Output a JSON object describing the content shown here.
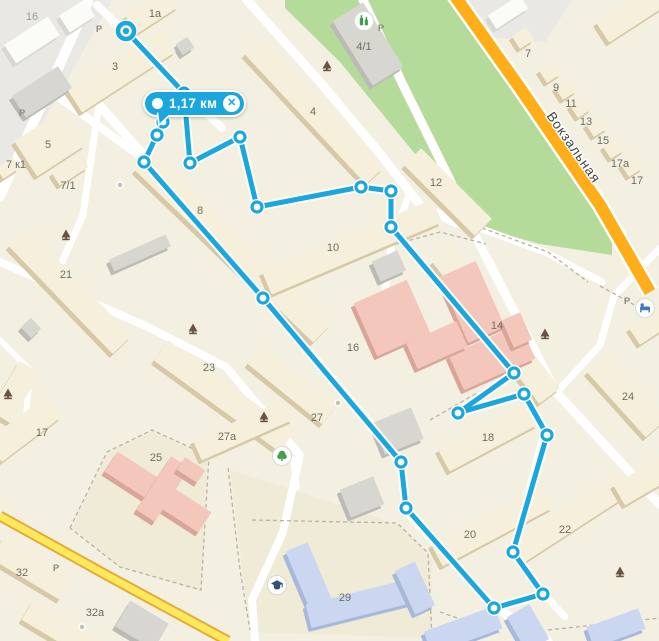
{
  "measurement": {
    "distance_label": "1,17 км",
    "close_glyph": "✕"
  },
  "street_label": {
    "text": "Вокзальная",
    "x": 570,
    "y": 150,
    "rot": 55
  },
  "colors": {
    "bg": "#F3EFE1",
    "park": "#B5DB9B",
    "industrial": "#E9E8E4",
    "yard": "#EFEBD7",
    "road": "#FFFFFF",
    "yellow": "#FFE95A",
    "yellowCase": "#E2AC3B",
    "orange": "#FFAD19",
    "orangeCase": "#FFFFFF",
    "dashed": "#B9B2A0",
    "route": "#1BA7DE",
    "routeHalo": "#FFFFFF",
    "label_num": "#6E6E62",
    "label_p": "#8C8C80",
    "label_grey": "#9C9C98",
    "street_text": "#45453F",
    "bldg": {
      "b": [
        "#F5EFDB",
        "#D7C9A6"
      ],
      "w": [
        "#FBFBF8",
        "#D8D7D2"
      ],
      "g": [
        "#D7D6D1",
        "#BBBAB5"
      ],
      "p": [
        "#F3C7BC",
        "#D8A598"
      ],
      "l": [
        "#CBD7F0",
        "#A8B8DB"
      ]
    },
    "poi_shop": "#3E9B4F",
    "poi_hotel": "#3D7ABF",
    "poi_park": "#44A04C",
    "poi_school": "#30517A",
    "monument": "#6B5342",
    "poi_dot": "#C4C0B4"
  },
  "areas": {
    "industrial": [
      [
        [
          0,
          0
        ],
        [
          112,
          0
        ],
        [
          0,
          198
        ]
      ],
      [
        [
          462,
          0
        ],
        [
          572,
          0
        ],
        [
          545,
          42
        ],
        [
          478,
          36
        ]
      ]
    ],
    "park": [
      [
        285,
        0
      ],
      [
        455,
        0
      ],
      [
        470,
        12
      ],
      [
        560,
        150
      ],
      [
        612,
        243
      ],
      [
        612,
        255
      ],
      [
        540,
        244
      ],
      [
        468,
        224
      ],
      [
        420,
        160
      ],
      [
        340,
        62
      ],
      [
        285,
        8
      ]
    ],
    "yards": [
      [
        [
          230,
          470
        ],
        [
          400,
          525
        ],
        [
          432,
          560
        ],
        [
          430,
          638
        ],
        [
          250,
          632
        ]
      ],
      [
        [
          72,
          528
        ],
        [
          108,
          453
        ],
        [
          152,
          431
        ],
        [
          208,
          457
        ],
        [
          201,
          590
        ],
        [
          120,
          567
        ]
      ]
    ],
    "dashed": [
      [
        [
          342,
          259
        ],
        [
          440,
          232
        ],
        [
          486,
          244
        ]
      ],
      [
        [
          70,
          528
        ],
        [
          107,
          452
        ],
        [
          152,
          430
        ],
        [
          209,
          456
        ],
        [
          201,
          590
        ],
        [
          120,
          567
        ],
        [
          70,
          528
        ]
      ],
      [
        [
          228,
          468
        ],
        [
          240,
          570
        ],
        [
          250,
          630
        ]
      ],
      [
        [
          252,
          520
        ],
        [
          397,
          523
        ],
        [
          428,
          553
        ],
        [
          432,
          638
        ]
      ],
      [
        [
          482,
          228
        ],
        [
          548,
          252
        ],
        [
          588,
          282
        ]
      ],
      [
        [
          430,
          420
        ],
        [
          477,
          393
        ]
      ],
      [
        [
          440,
          612
        ],
        [
          500,
          633
        ]
      ],
      [
        [
          548,
          630
        ],
        [
          660,
          618
        ]
      ],
      [
        [
          600,
          286
        ],
        [
          658,
          318
        ]
      ]
    ]
  },
  "roads": {
    "white": [
      {
        "w": 10,
        "pts": [
          [
            0,
            196
          ],
          [
            88,
            2
          ]
        ]
      },
      {
        "w": 8,
        "pts": [
          [
            60,
            98
          ],
          [
            148,
            162
          ]
        ]
      },
      {
        "w": 9,
        "pts": [
          [
            100,
            106
          ],
          [
            148,
            160
          ],
          [
            263,
            298
          ],
          [
            401,
            460
          ],
          [
            406,
            510
          ],
          [
            493,
            606
          ],
          [
            548,
            641
          ]
        ]
      },
      {
        "w": 7,
        "pts": [
          [
            98,
            110
          ],
          [
            83,
            215
          ],
          [
            62,
            262
          ]
        ]
      },
      {
        "w": 8,
        "pts": [
          [
            0,
            262
          ],
          [
            148,
            327
          ],
          [
            226,
            367
          ],
          [
            300,
            455
          ],
          [
            283,
            532
          ],
          [
            252,
            600
          ],
          [
            255,
            641
          ]
        ]
      },
      {
        "w": 8,
        "pts": [
          [
            97,
            5
          ],
          [
            170,
            78
          ],
          [
            222,
            128
          ]
        ]
      },
      {
        "w": 9,
        "pts": [
          [
            247,
            0
          ],
          [
            320,
            82
          ],
          [
            377,
            150
          ],
          [
            420,
            205
          ],
          [
            456,
            223
          ]
        ]
      },
      {
        "w": 9,
        "pts": [
          [
            363,
            0
          ],
          [
            403,
            85
          ],
          [
            450,
            180
          ],
          [
            468,
            222
          ],
          [
            556,
            392
          ],
          [
            660,
            505
          ]
        ]
      },
      {
        "w": 7,
        "pts": [
          [
            468,
            224
          ],
          [
            545,
            252
          ],
          [
            602,
            282
          ]
        ]
      },
      {
        "w": 7,
        "pts": [
          [
            660,
            248
          ],
          [
            614,
            296
          ],
          [
            600,
            345
          ],
          [
            558,
            391
          ]
        ]
      },
      {
        "w": 7,
        "pts": [
          [
            545,
            428
          ],
          [
            513,
            552
          ],
          [
            543,
            593
          ],
          [
            565,
            617
          ]
        ]
      },
      {
        "w": 6,
        "pts": [
          [
            263,
            438
          ],
          [
            293,
            460
          ],
          [
            297,
            487
          ]
        ]
      },
      {
        "w": 6,
        "pts": [
          [
            0,
            340
          ],
          [
            30,
            370
          ],
          [
            25,
            428
          ]
        ]
      },
      {
        "w": 7,
        "pts": [
          [
            410,
            192
          ],
          [
            392,
            240
          ],
          [
            384,
            300
          ]
        ]
      }
    ],
    "yellow": {
      "pts": [
        [
          0,
          516
        ],
        [
          110,
          577
        ],
        [
          228,
          641
        ]
      ],
      "w_case": 11,
      "w_core": 7
    },
    "orange": {
      "pts": [
        [
          452,
          -8
        ],
        [
          520,
          88
        ],
        [
          600,
          205
        ],
        [
          650,
          292
        ]
      ],
      "w_case": 17,
      "w_core": 12
    }
  },
  "buildings": [
    [
      152,
      11,
      50,
      22,
      -33,
      "b"
    ],
    [
      185,
      46,
      14,
      13,
      -33,
      "g"
    ],
    [
      122,
      71,
      112,
      26,
      -33,
      "b"
    ],
    [
      50,
      143,
      58,
      42,
      -33,
      "b"
    ],
    [
      70,
      170,
      34,
      15,
      -33,
      "b"
    ],
    [
      8,
      168,
      20,
      13,
      -33,
      "b"
    ],
    [
      233,
      247,
      248,
      26,
      44,
      "b"
    ],
    [
      352,
      247,
      185,
      25,
      -23,
      "b"
    ],
    [
      314,
      111,
      178,
      24,
      47,
      "b"
    ],
    [
      368,
      44,
      76,
      36,
      58,
      "g"
    ],
    [
      448,
      192,
      100,
      24,
      45,
      "b"
    ],
    [
      496,
      325,
      178,
      26,
      53,
      "b"
    ],
    [
      70,
      291,
      150,
      26,
      46,
      "b"
    ],
    [
      140,
      253,
      62,
      13,
      -24,
      "g"
    ],
    [
      31,
      328,
      15,
      14,
      46,
      "g"
    ],
    [
      224,
      396,
      155,
      25,
      36,
      "b"
    ],
    [
      292,
      385,
      96,
      23,
      39,
      "b"
    ],
    [
      243,
      430,
      100,
      22,
      -24,
      "b"
    ],
    [
      15,
      392,
      58,
      24,
      -59,
      "b"
    ],
    [
      24,
      429,
      75,
      26,
      -37,
      "b"
    ],
    [
      488,
      437,
      100,
      25,
      -28,
      "b"
    ],
    [
      492,
      526,
      125,
      25,
      -28,
      "b"
    ],
    [
      573,
      516,
      132,
      25,
      -33,
      "b"
    ],
    [
      626,
      396,
      88,
      26,
      48,
      "b"
    ],
    [
      652,
      325,
      42,
      20,
      -33,
      "b"
    ],
    [
      634,
      12,
      75,
      24,
      -33,
      "b"
    ],
    [
      523,
      38,
      17,
      15,
      -33,
      "b"
    ],
    [
      550,
      72,
      17,
      15,
      -33,
      "b"
    ],
    [
      566,
      89,
      17,
      15,
      -33,
      "b"
    ],
    [
      581,
      107,
      17,
      15,
      -33,
      "b"
    ],
    [
      597,
      126,
      17,
      15,
      -33,
      "b"
    ],
    [
      614,
      148,
      17,
      15,
      -33,
      "b"
    ],
    [
      632,
      166,
      17,
      15,
      -33,
      "b"
    ],
    [
      645,
      480,
      60,
      24,
      -30,
      "b"
    ],
    [
      32,
      568,
      80,
      26,
      31,
      "b"
    ],
    [
      62,
      630,
      80,
      24,
      31,
      "b"
    ],
    [
      142,
      625,
      45,
      30,
      31,
      "g"
    ],
    [
      32,
      40,
      52,
      22,
      -33,
      "w"
    ],
    [
      77,
      16,
      30,
      20,
      -33,
      "w"
    ],
    [
      42,
      92,
      55,
      26,
      -33,
      "g"
    ],
    [
      508,
      12,
      38,
      16,
      -33,
      "w"
    ],
    [
      389,
      266,
      28,
      22,
      -24,
      "g"
    ],
    [
      398,
      431,
      42,
      34,
      -22,
      "g"
    ],
    [
      362,
      497,
      36,
      30,
      -22,
      "g"
    ],
    [
      392,
      318,
      58,
      58,
      -24,
      "p"
    ],
    [
      472,
      302,
      40,
      72,
      -24,
      "p"
    ],
    [
      492,
      357,
      78,
      38,
      -24,
      "p"
    ],
    [
      437,
      345,
      55,
      28,
      -24,
      "p"
    ],
    [
      517,
      330,
      30,
      20,
      66,
      "p"
    ],
    [
      158,
      492,
      112,
      24,
      33,
      "p"
    ],
    [
      163,
      489,
      64,
      22,
      -57,
      "p"
    ],
    [
      191,
      470,
      24,
      15,
      33,
      "p"
    ],
    [
      311,
      581,
      74,
      24,
      67,
      "l"
    ],
    [
      362,
      603,
      110,
      24,
      -14,
      "l"
    ],
    [
      415,
      588,
      48,
      22,
      65,
      "l"
    ],
    [
      463,
      630,
      75,
      24,
      -20,
      "l"
    ],
    [
      528,
      628,
      40,
      26,
      60,
      "l"
    ],
    [
      616,
      628,
      55,
      22,
      -20,
      "l"
    ]
  ],
  "labels": [
    {
      "t": "16",
      "x": 32,
      "y": 16,
      "c": "grey"
    },
    {
      "t": "1a",
      "x": 155,
      "y": 13,
      "c": "num"
    },
    {
      "t": "P",
      "x": 99,
      "y": 28,
      "c": "p"
    },
    {
      "t": "3",
      "x": 115,
      "y": 66,
      "c": "num"
    },
    {
      "t": "P",
      "x": 22,
      "y": 112,
      "c": "p"
    },
    {
      "t": "5",
      "x": 48,
      "y": 144,
      "c": "num"
    },
    {
      "t": "7 к1",
      "x": 16,
      "y": 164,
      "c": "num"
    },
    {
      "t": "7/1",
      "x": 68,
      "y": 185,
      "c": "num"
    },
    {
      "t": "8",
      "x": 200,
      "y": 210,
      "c": "num"
    },
    {
      "t": "4/1",
      "x": 364,
      "y": 46,
      "c": "num"
    },
    {
      "t": "P",
      "x": 381,
      "y": 27,
      "c": "p"
    },
    {
      "t": "4",
      "x": 313,
      "y": 111,
      "c": "num"
    },
    {
      "t": "12",
      "x": 436,
      "y": 182,
      "c": "num"
    },
    {
      "t": "7",
      "x": 528,
      "y": 53,
      "c": "num"
    },
    {
      "t": "9",
      "x": 556,
      "y": 87,
      "c": "num"
    },
    {
      "t": "11",
      "x": 571,
      "y": 103,
      "c": "num"
    },
    {
      "t": "13",
      "x": 586,
      "y": 121,
      "c": "num"
    },
    {
      "t": "15",
      "x": 603,
      "y": 140,
      "c": "num"
    },
    {
      "t": "17a",
      "x": 620,
      "y": 163,
      "c": "num"
    },
    {
      "t": "17",
      "x": 637,
      "y": 180,
      "c": "num"
    },
    {
      "t": "21",
      "x": 66,
      "y": 274,
      "c": "num"
    },
    {
      "t": "10",
      "x": 333,
      "y": 247,
      "c": "num"
    },
    {
      "t": "16",
      "x": 353,
      "y": 347,
      "c": "num"
    },
    {
      "t": "14",
      "x": 497,
      "y": 325,
      "c": "num"
    },
    {
      "t": "23",
      "x": 209,
      "y": 367,
      "c": "num"
    },
    {
      "t": "24",
      "x": 628,
      "y": 396,
      "c": "num"
    },
    {
      "t": "27",
      "x": 317,
      "y": 417,
      "c": "num"
    },
    {
      "t": "27a",
      "x": 227,
      "y": 436,
      "c": "num"
    },
    {
      "t": "17",
      "x": 42,
      "y": 432,
      "c": "num"
    },
    {
      "t": "18",
      "x": 488,
      "y": 437,
      "c": "num"
    },
    {
      "t": "P",
      "x": 627,
      "y": 300,
      "c": "p"
    },
    {
      "t": "25",
      "x": 156,
      "y": 457,
      "c": "num"
    },
    {
      "t": "20",
      "x": 470,
      "y": 534,
      "c": "num"
    },
    {
      "t": "22",
      "x": 565,
      "y": 529,
      "c": "num"
    },
    {
      "t": "29",
      "x": 345,
      "y": 597,
      "c": "num"
    },
    {
      "t": "32",
      "x": 22,
      "y": 572,
      "c": "num"
    },
    {
      "t": "P",
      "x": 56,
      "y": 567,
      "c": "p"
    },
    {
      "t": "32a",
      "x": 95,
      "y": 612,
      "c": "num"
    }
  ],
  "pois": {
    "monuments": [
      [
        327,
        65
      ],
      [
        66,
        234
      ],
      [
        193,
        328
      ],
      [
        8,
        393
      ],
      [
        545,
        333
      ],
      [
        264,
        416
      ],
      [
        620,
        571
      ]
    ],
    "circles": [
      {
        "x": 364,
        "y": 21,
        "kind": "shop"
      },
      {
        "x": 645,
        "y": 308,
        "kind": "hotel"
      },
      {
        "x": 282,
        "y": 456,
        "kind": "park"
      },
      {
        "x": 277,
        "y": 585,
        "kind": "school"
      }
    ],
    "dots": [
      [
        120,
        185
      ],
      [
        82,
        627
      ],
      [
        338,
        403
      ]
    ]
  },
  "route": {
    "points": [
      [
        126,
        31
      ],
      [
        184,
        93
      ],
      [
        190,
        163
      ],
      [
        240,
        137
      ],
      [
        257,
        207
      ],
      [
        361,
        187
      ],
      [
        391,
        191
      ],
      [
        391,
        227
      ],
      [
        514,
        373
      ],
      [
        458,
        413
      ],
      [
        524,
        394
      ],
      [
        547,
        435
      ],
      [
        513,
        552
      ],
      [
        543,
        594
      ],
      [
        494,
        608
      ],
      [
        406,
        508
      ],
      [
        401,
        462
      ],
      [
        263,
        298
      ],
      [
        144,
        162
      ],
      [
        157,
        135
      ],
      [
        163,
        122
      ]
    ]
  }
}
